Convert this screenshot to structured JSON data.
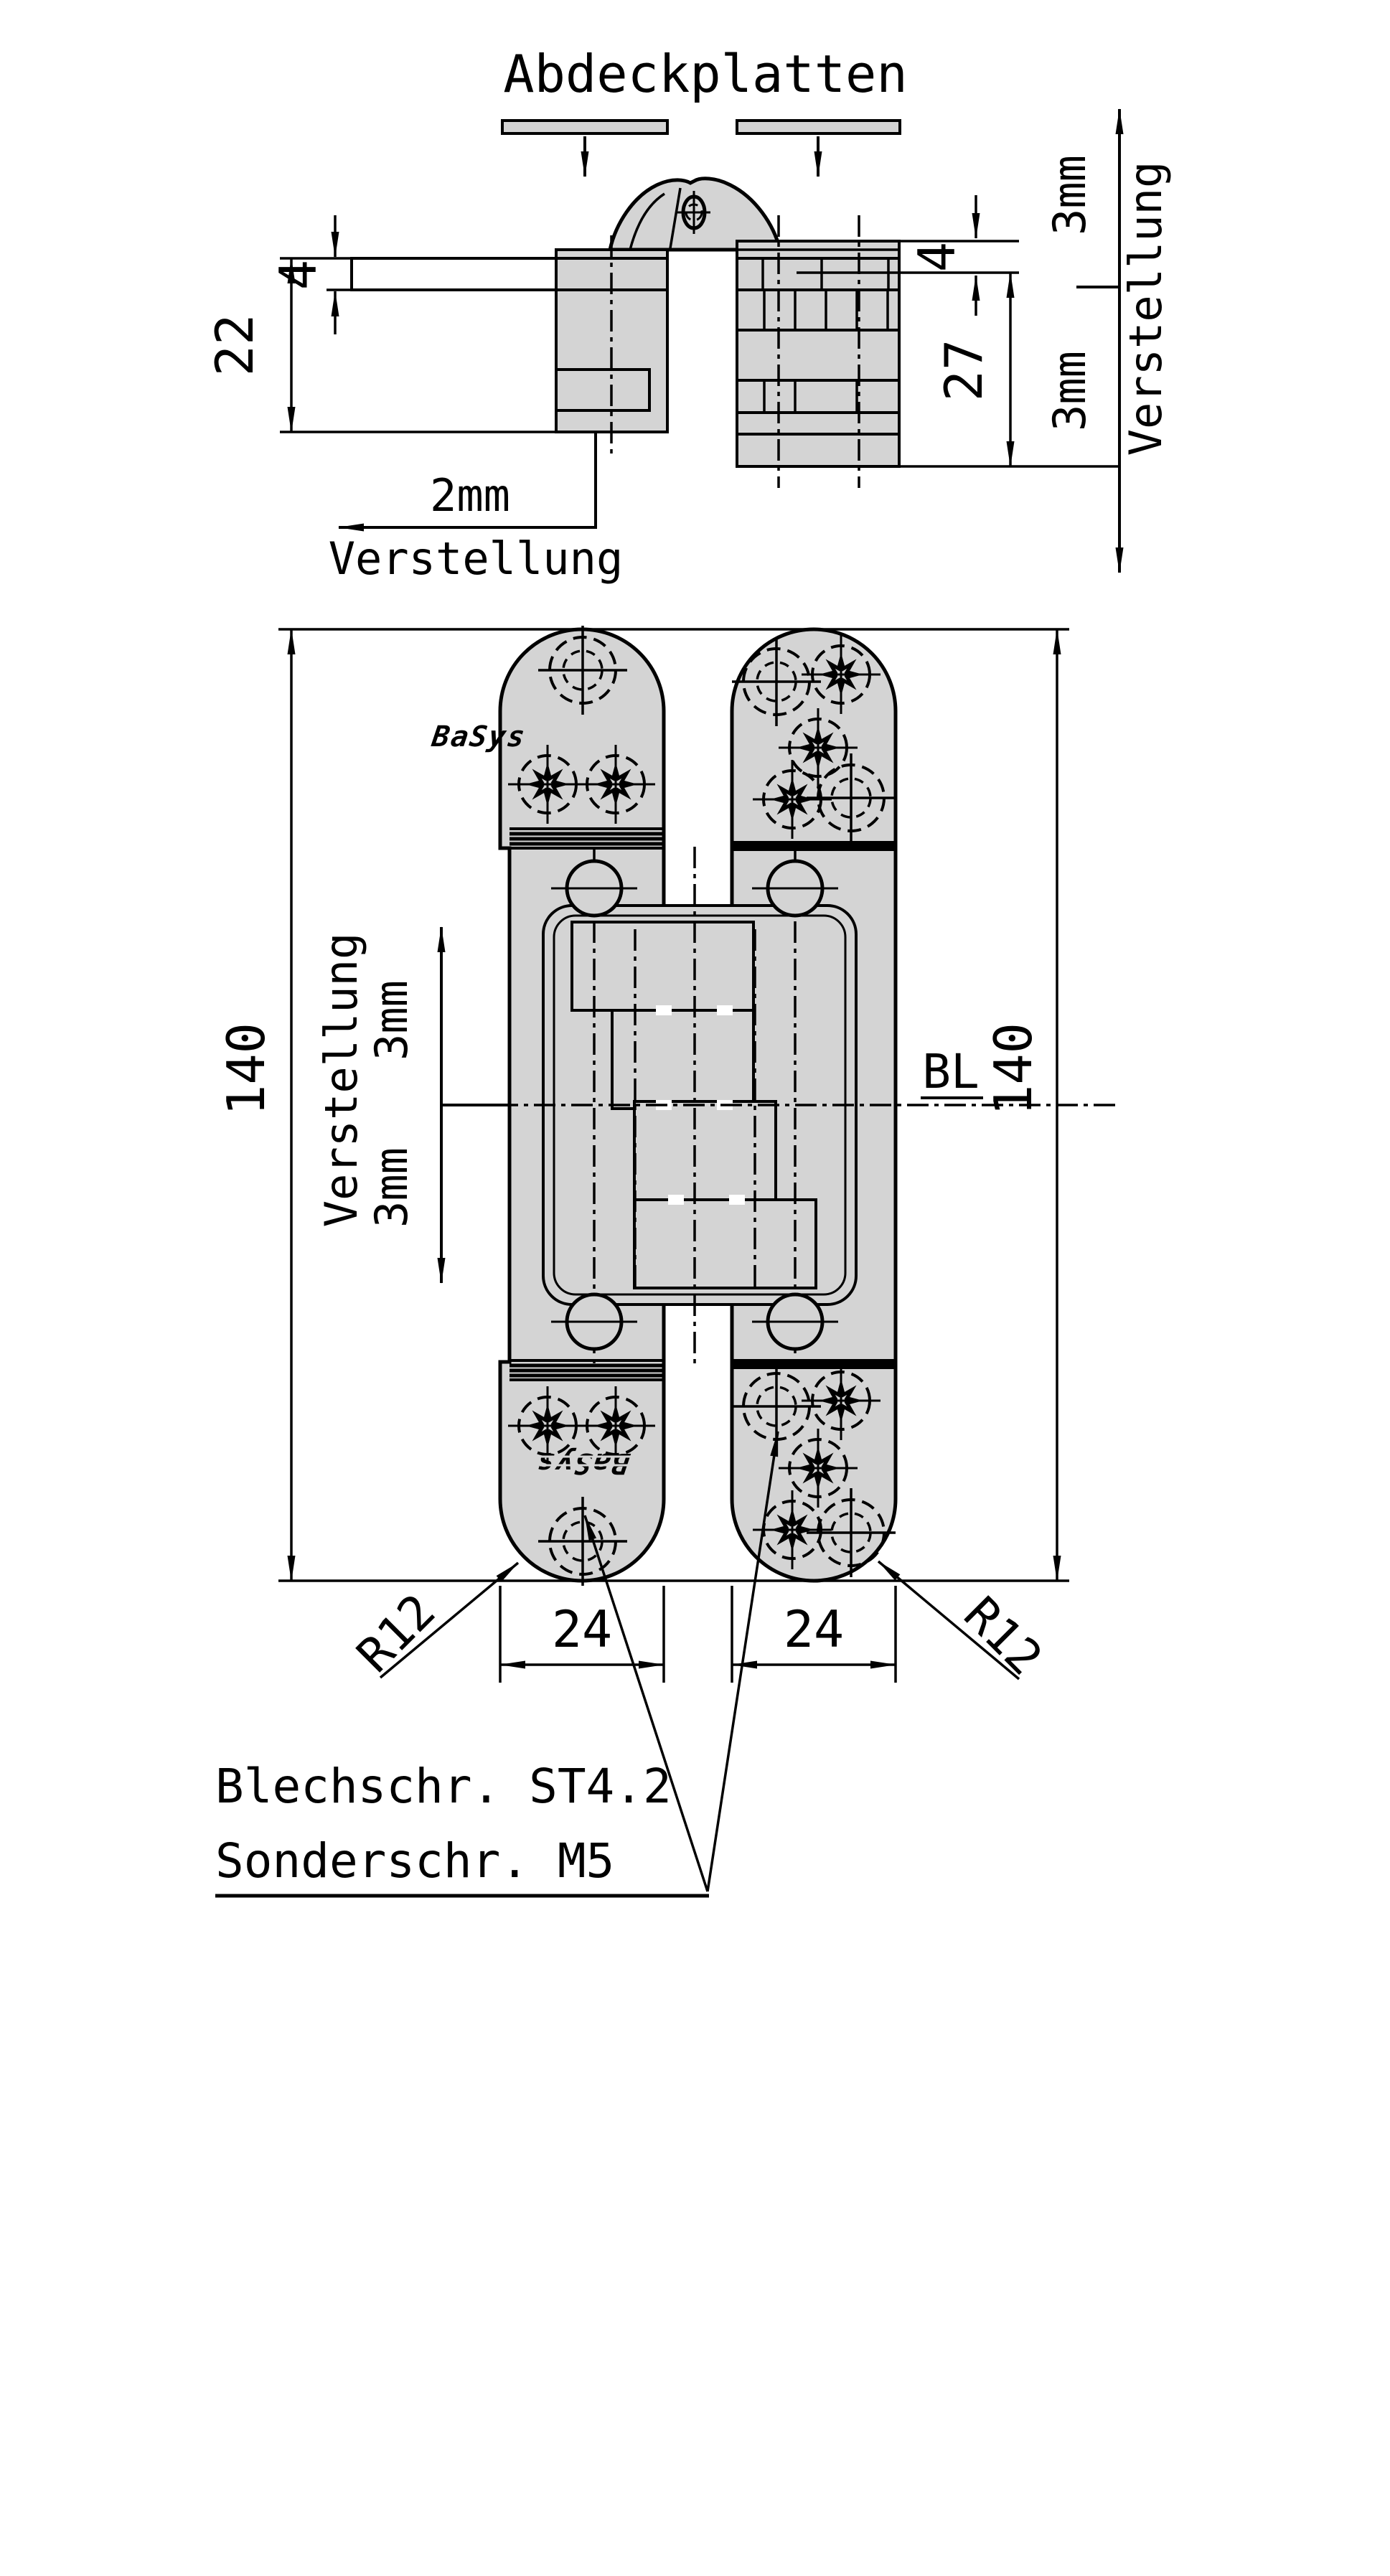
{
  "drawing": {
    "type": "technical-drawing",
    "subject": "concealed hinge, two views (horizontal section and front view)",
    "colors": {
      "line": "#000000",
      "part_fill": "#d4d4d4",
      "background": "#ffffff"
    }
  },
  "top_view": {
    "title": "Abdeckplatten",
    "dim_left_small": "4",
    "dim_left": "22",
    "dim_right_small": "4",
    "dim_right": "27",
    "leader_value": "2mm",
    "leader_label": "Verstellung",
    "adjust_top": "3mm",
    "adjust_bottom": "3mm",
    "adjust_label": "Verstellung"
  },
  "front_view": {
    "dim_left": "140",
    "dim_right": "140",
    "bl": "BL",
    "adj_label": "Verstellung",
    "adj_top": "3mm",
    "adj_bottom": "3mm",
    "r_left": "R12",
    "r_right": "R12",
    "w_left": "24",
    "w_right": "24",
    "logo_top": "BaSys",
    "logo_bottom": "BaSys"
  },
  "notes": {
    "line1": "Blechschr. ST4.2",
    "line2": "Sonderschr. M5"
  }
}
